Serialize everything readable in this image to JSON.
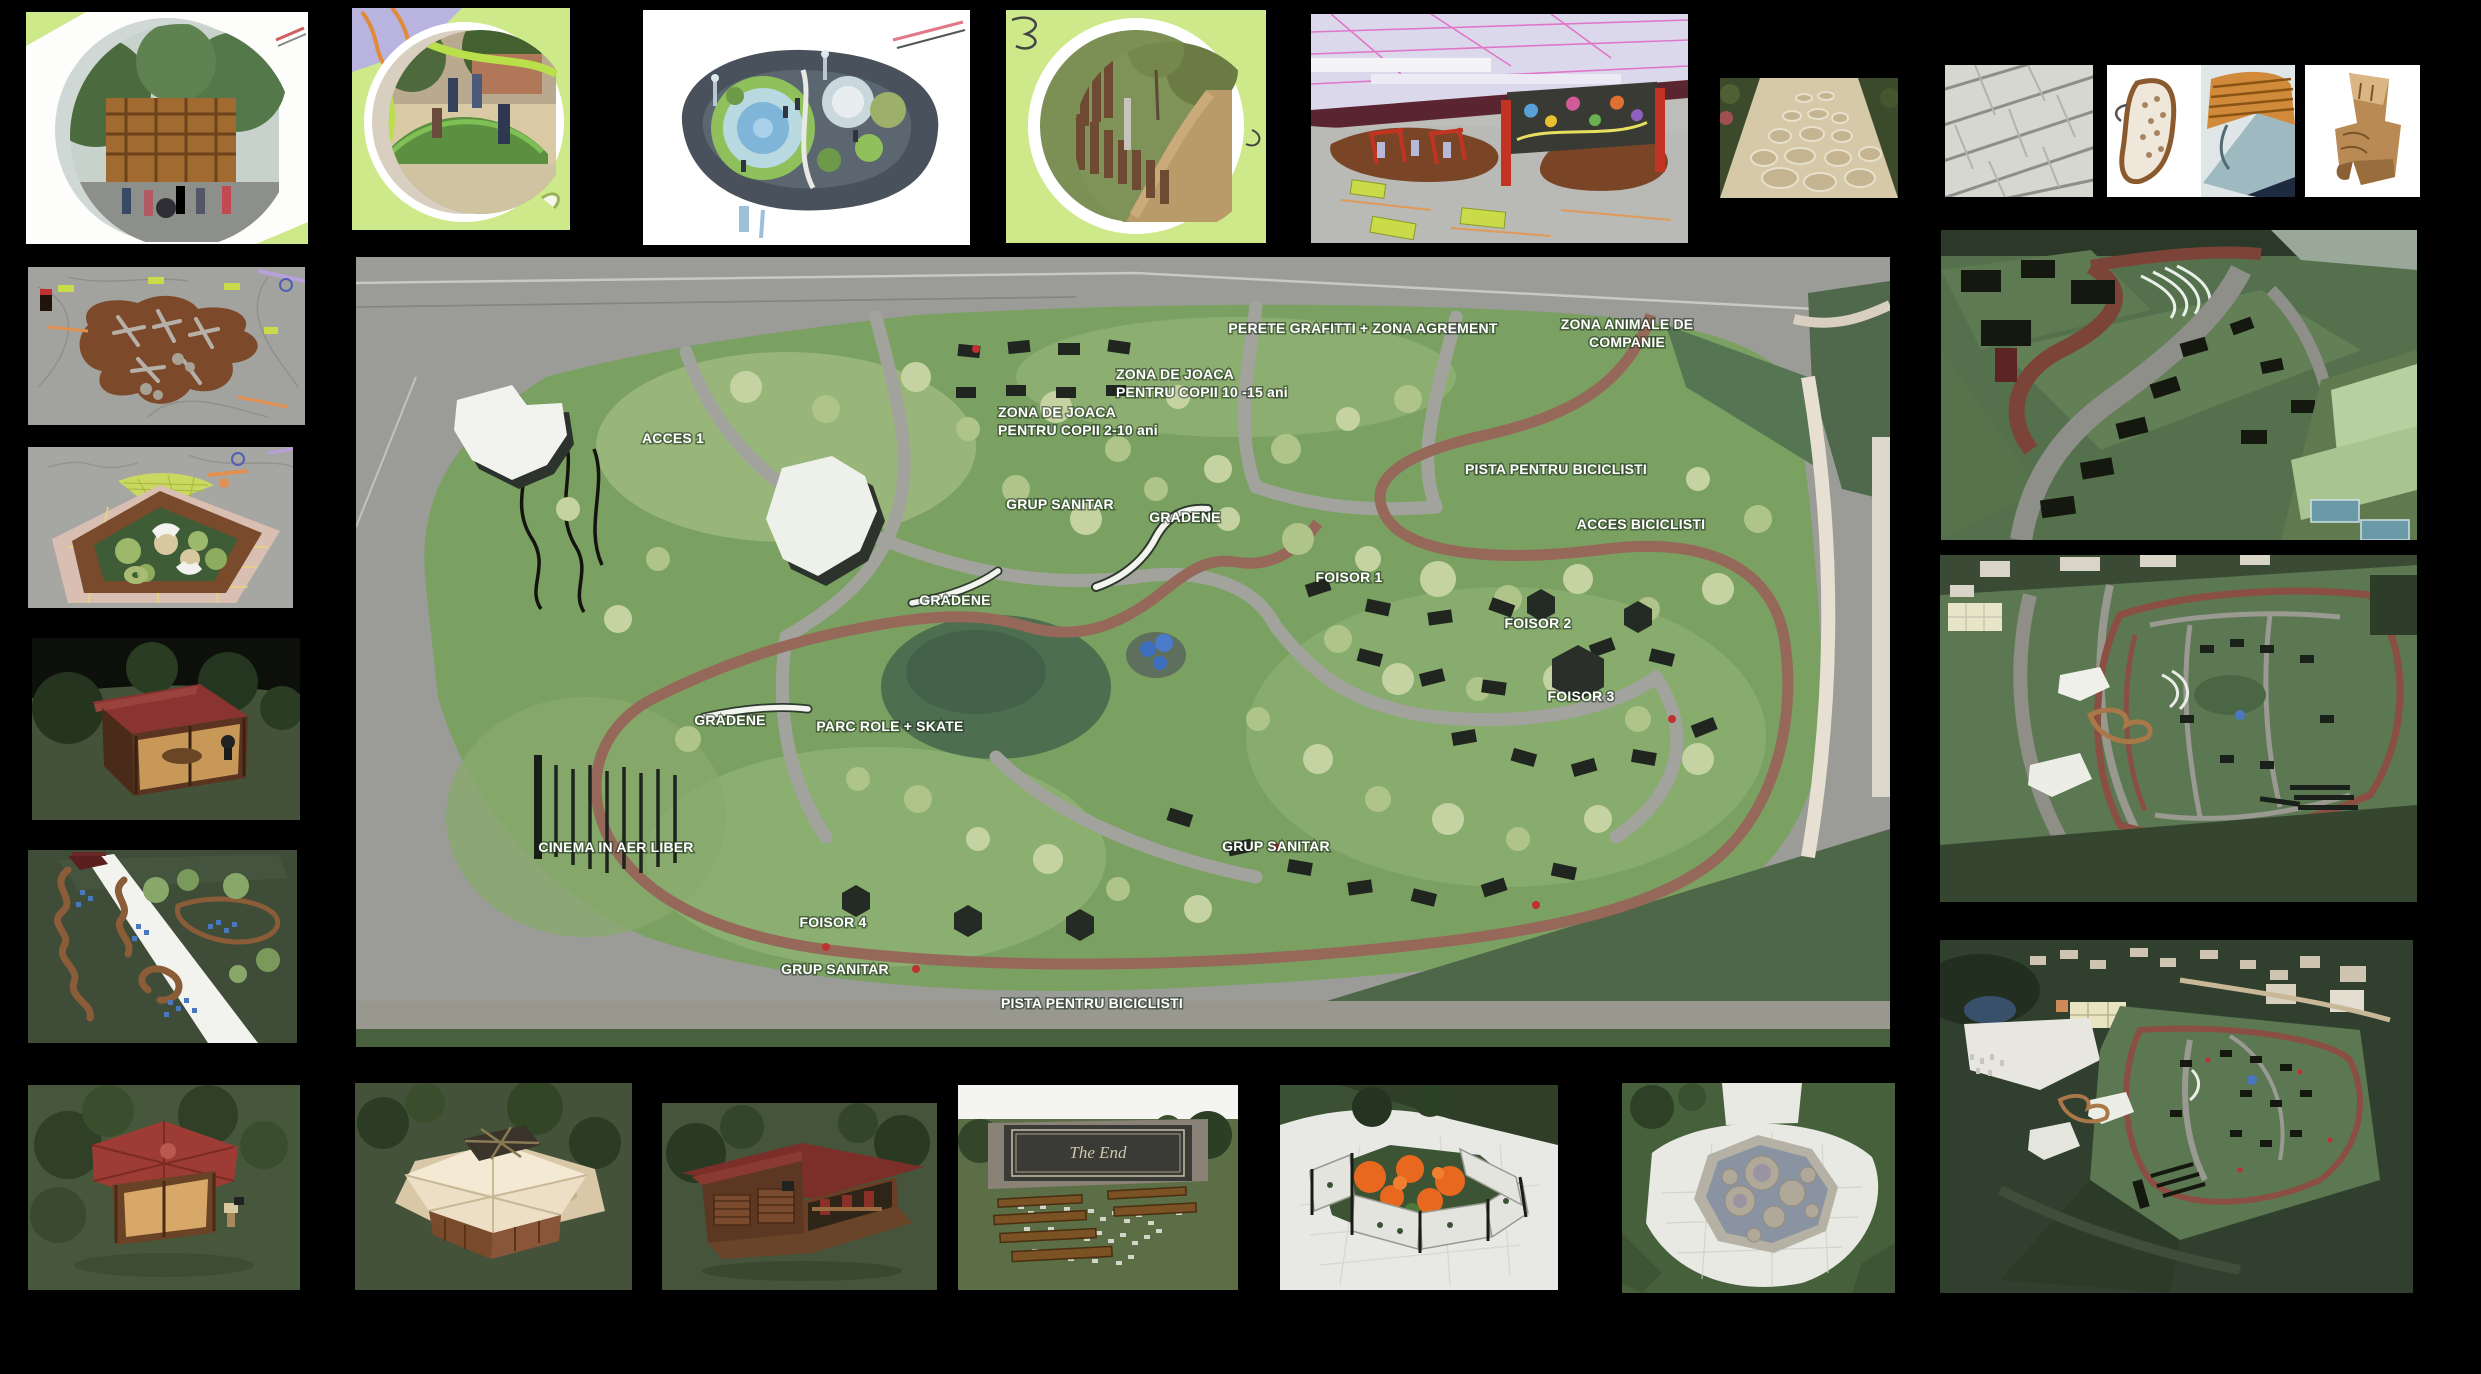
{
  "canvas": {
    "width": 2481,
    "height": 1374,
    "background": "#000000"
  },
  "palette": {
    "board_background": "#000000",
    "plan_street_gray": "#9b9b97",
    "park_green": "#7ba162",
    "lawn_light_green": "#a9c189",
    "tree_pale_green": "#c4d3a1",
    "dark_green": "#4f6749",
    "bike_path_brown": "#96685a",
    "path_gray": "#a3a39e",
    "label_white": "#ffffff",
    "card_lime": "#cde98a",
    "graffiti_red": "#c23322"
  },
  "plan": {
    "name": "park-master-plan",
    "labels": [
      {
        "text": "PERETE GRAFITTI + ZONA AGREMENT",
        "x": 1007,
        "y": 76,
        "anchor": "middle"
      },
      {
        "text": "ZONA ANIMALE DE",
        "x": 1271,
        "y": 72,
        "anchor": "middle"
      },
      {
        "text": "COMPANIE",
        "x": 1271,
        "y": 90,
        "anchor": "middle"
      },
      {
        "text": "ZONA DE JOACA",
        "x": 760,
        "y": 122,
        "anchor": "start"
      },
      {
        "text": "PENTRU COPII 10 -15 ani",
        "x": 760,
        "y": 140,
        "anchor": "start"
      },
      {
        "text": "ZONA DE JOACA",
        "x": 642,
        "y": 160,
        "anchor": "start"
      },
      {
        "text": "PENTRU COPII 2-10 ani",
        "x": 642,
        "y": 178,
        "anchor": "start"
      },
      {
        "text": "ACCES 1",
        "x": 317,
        "y": 186,
        "anchor": "middle"
      },
      {
        "text": "PISTA PENTRU BICICLISTI",
        "x": 1200,
        "y": 217,
        "anchor": "middle"
      },
      {
        "text": "GRUP SANITAR",
        "x": 704,
        "y": 252,
        "anchor": "middle"
      },
      {
        "text": "GRADENE",
        "x": 829,
        "y": 265,
        "anchor": "middle"
      },
      {
        "text": "ACCES BICICLISTI",
        "x": 1285,
        "y": 272,
        "anchor": "middle"
      },
      {
        "text": "FOISOR 1",
        "x": 993,
        "y": 325,
        "anchor": "middle"
      },
      {
        "text": "GRADENE",
        "x": 599,
        "y": 348,
        "anchor": "middle"
      },
      {
        "text": "FOISOR 2",
        "x": 1182,
        "y": 371,
        "anchor": "middle"
      },
      {
        "text": "FOISOR 3",
        "x": 1225,
        "y": 444,
        "anchor": "middle"
      },
      {
        "text": "GRADENE",
        "x": 374,
        "y": 468,
        "anchor": "middle"
      },
      {
        "text": "PARC ROLE + SKATE",
        "x": 534,
        "y": 474,
        "anchor": "middle"
      },
      {
        "text": "CINEMA IN AER LIBER",
        "x": 260,
        "y": 595,
        "anchor": "middle"
      },
      {
        "text": "GRUP SANITAR",
        "x": 920,
        "y": 594,
        "anchor": "middle"
      },
      {
        "text": "FOISOR 4",
        "x": 477,
        "y": 670,
        "anchor": "middle"
      },
      {
        "text": "GRUP SANITAR",
        "x": 479,
        "y": 717,
        "anchor": "middle"
      },
      {
        "text": "PISTA PENTRU BICICLISTI",
        "x": 736,
        "y": 751,
        "anchor": "middle"
      }
    ]
  },
  "thumbnails": {
    "top_row": [
      {
        "name": "photo-timber-building-circle"
      },
      {
        "name": "photo-kids-playground-circle"
      },
      {
        "name": "render-circular-playground-card"
      },
      {
        "name": "photo-corten-palisade-circle"
      },
      {
        "name": "render-graffiti-wall-playground"
      },
      {
        "name": "photo-flagstone-paving"
      },
      {
        "name": "photo-stone-shingles"
      },
      {
        "name": "render-designer-chairs"
      },
      {
        "name": "render-log-chair"
      }
    ],
    "left_column": [
      {
        "name": "render-log-playground-plan"
      },
      {
        "name": "render-pentagon-sand-playground"
      },
      {
        "name": "render-square-gazebo-night"
      },
      {
        "name": "render-mosaic-path-aerial"
      }
    ],
    "right_column": [
      {
        "name": "render-gradene-bikepath-perspective"
      },
      {
        "name": "render-park-aerial-overview"
      },
      {
        "name": "render-site-birdseye-night"
      }
    ],
    "bottom_row": [
      {
        "name": "render-hex-gazebo-red-roof"
      },
      {
        "name": "render-pavilion-cream-roof-skylight"
      },
      {
        "name": "render-pavilion-dark-red-roof"
      },
      {
        "name": "render-open-air-cinema",
        "screen_text": "The End"
      },
      {
        "name": "render-octagon-flower-enclosure"
      },
      {
        "name": "render-octagon-fountain-topview"
      }
    ]
  }
}
